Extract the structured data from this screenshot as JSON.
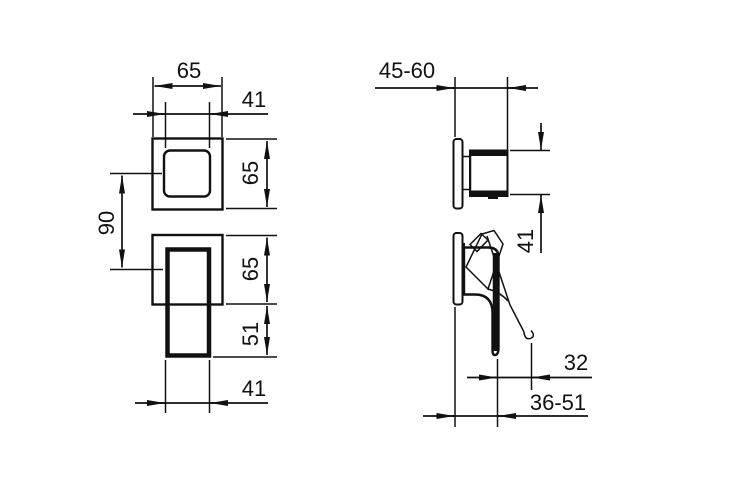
{
  "drawing": {
    "kind": "technical-dimension-drawing",
    "subject": "concealed-mixer-valve-two-views",
    "colors": {
      "line": "#111111",
      "background": "#ffffff"
    },
    "views": {
      "front": {
        "labels": {
          "plate_width": "65",
          "knob_width": "41",
          "upper_plate_height": "65",
          "center_distance": "90",
          "lower_plate_height": "65",
          "lever_overhang": "51",
          "lever_width": "41"
        }
      },
      "side": {
        "labels": {
          "wall_depth_range": "45-60",
          "knob_height": "41",
          "lever_travel": "32",
          "body_depth_range": "36-51"
        }
      }
    }
  }
}
